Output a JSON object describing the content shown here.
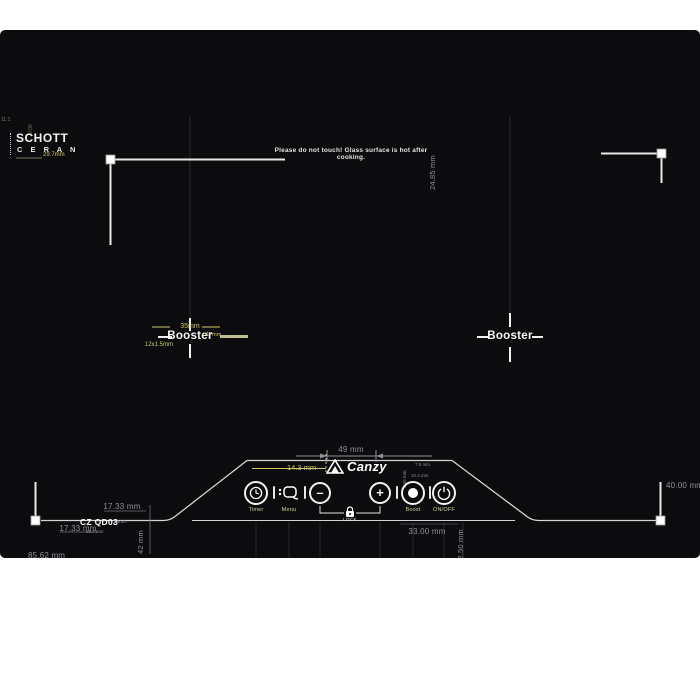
{
  "glass": {
    "warning": "Please do not touch! Glass surface is hot after cooking.",
    "schott_line1": "SCHOTT",
    "schott_line2": "C E R A N",
    "model": "CZ QD03",
    "brand": "Canzy",
    "booster_left": "Booster",
    "booster_right": "Booster"
  },
  "controls": {
    "timer_label": "Timer",
    "menu_label": "Menu",
    "minus_symbol": "–",
    "plus_symbol": "+",
    "boost_label": "Boost",
    "onoff_label": "ON/OFF",
    "lock_label": "LOCK"
  },
  "dimensions": {
    "corner_radius": "29.7mm",
    "edge_fragment_horizontal": "11.1",
    "edge_fragment_vertical": "0.00",
    "top_right_vertical": "24.85 mm",
    "burner_zone_width": "35mm",
    "burner_coil": "12x1.5mm",
    "burner_right": "17mm",
    "logo_width": "49 mm",
    "logo_offset": "14.3 mm",
    "panel_tiny_1": "7.5 mm",
    "panel_tiny_2": "10.4 mm",
    "panel_tiny_3": "2.45 mm",
    "panel_height_vertical": "52.50 mm",
    "panel_bottom_width": "33.00 mm",
    "bottom_left_upper": "17.33 mm",
    "bottom_left_lower": "17.33 mm",
    "model_side_tiny": "3.5mm",
    "model_under_tiny": "28.4 mm",
    "bottom_left_vertical": "42 mm",
    "bottom_left_edge": "85.62 mm",
    "bottom_right_horizontal": "40.00 mm",
    "bottom_right_vertical": "30.00 mm"
  },
  "colors": {
    "glass_black": "#0c0c0e",
    "dim_gray": "#8f9099",
    "dim_yellow": "#cfc96a",
    "line_white": "#d4d4d4",
    "label_yellow": "#d6d29a"
  }
}
